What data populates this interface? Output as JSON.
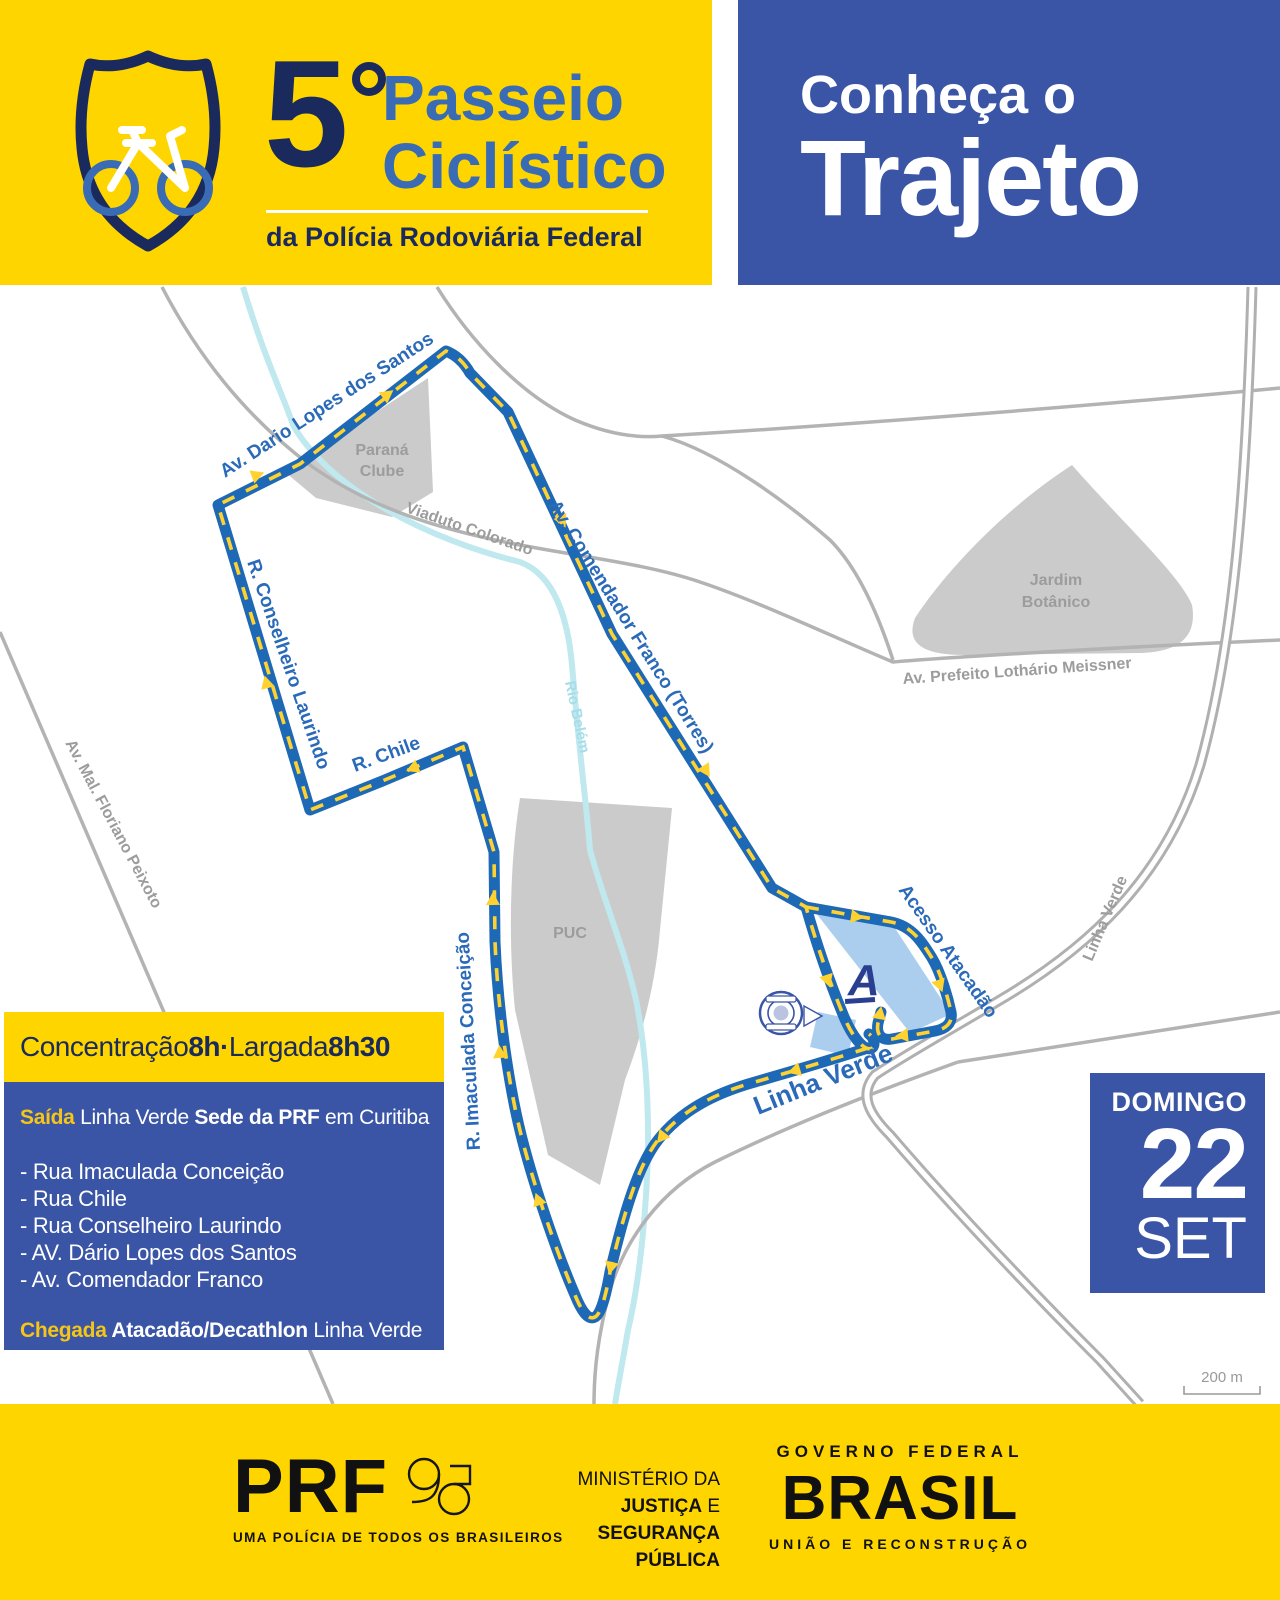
{
  "colors": {
    "yellow": "#FFD500",
    "panel_blue": "#3A55A5",
    "route_blue": "#1D69B5",
    "navy": "#1B2A5C",
    "title_blue": "#3A6BB5"
  },
  "header": {
    "number": "5",
    "title_line1": "Passeio",
    "title_line2": "Ciclístico",
    "subtitle": "da Polícia Rodoviária Federal",
    "right_small": "Conheça o",
    "right_big": "Trajeto"
  },
  "map": {
    "labels": {
      "dario": "Av. Dario Lopes dos Santos",
      "comendador": "Av. Comendador Franco (Torres)",
      "laurindo": "R. Conselheiro Laurindo",
      "chile": "R. Chile",
      "imaculada": "R. Imaculada Conceição",
      "linha_verde_route": "Linha Verde",
      "acesso_atacadao": "Acesso Atacadão",
      "viaduto": "Viaduto Colorado",
      "meissner": "Av. Prefeito Lothário Meissner",
      "floriano": "Av. Mal. Floriano Peixoto",
      "linha_verde_road": "Linha Verde",
      "rio_belem": "Rio Belém",
      "parana_1": "Paraná",
      "parana_2": "Clube",
      "jardim_1": "Jardim",
      "jardim_2": "Botânico",
      "puc": "PUC",
      "atacadao_logo": "A"
    },
    "scale_label": "200 m"
  },
  "info_box": {
    "bar": {
      "text1": "Concentração ",
      "bold1": "8h",
      "sep": " · ",
      "text2": "Largada ",
      "bold2": "8h30"
    },
    "saida": {
      "key": "Saída",
      "text1": " Linha Verde ",
      "bold": "Sede da PRF",
      "text2": " em Curitiba"
    },
    "items": [
      "- Rua Imaculada Conceição",
      "- Rua Chile",
      "- Rua Conselheiro Laurindo",
      "- AV. Dário Lopes dos Santos",
      "- Av. Comendador Franco"
    ],
    "chegada": {
      "key": "Chegada",
      "bold": " Atacadão/Decathlon",
      "text": " Linha Verde"
    }
  },
  "date_box": {
    "weekday": "DOMINGO",
    "day": "22",
    "month": "SET"
  },
  "footer": {
    "prf": "PRF",
    "prf_tagline": "UMA POLÍCIA DE TODOS OS BRASILEIROS",
    "ministry_1": "MINISTÉRIO DA",
    "ministry_2_bold": "JUSTIÇA",
    "ministry_2_rest": " E",
    "ministry_3": "SEGURANÇA PÚBLICA",
    "gov_top": "GOVERNO FEDERAL",
    "gov_logo": "BRASIL",
    "gov_bottom": "UNIÃO E RECONSTRUÇÃO"
  }
}
